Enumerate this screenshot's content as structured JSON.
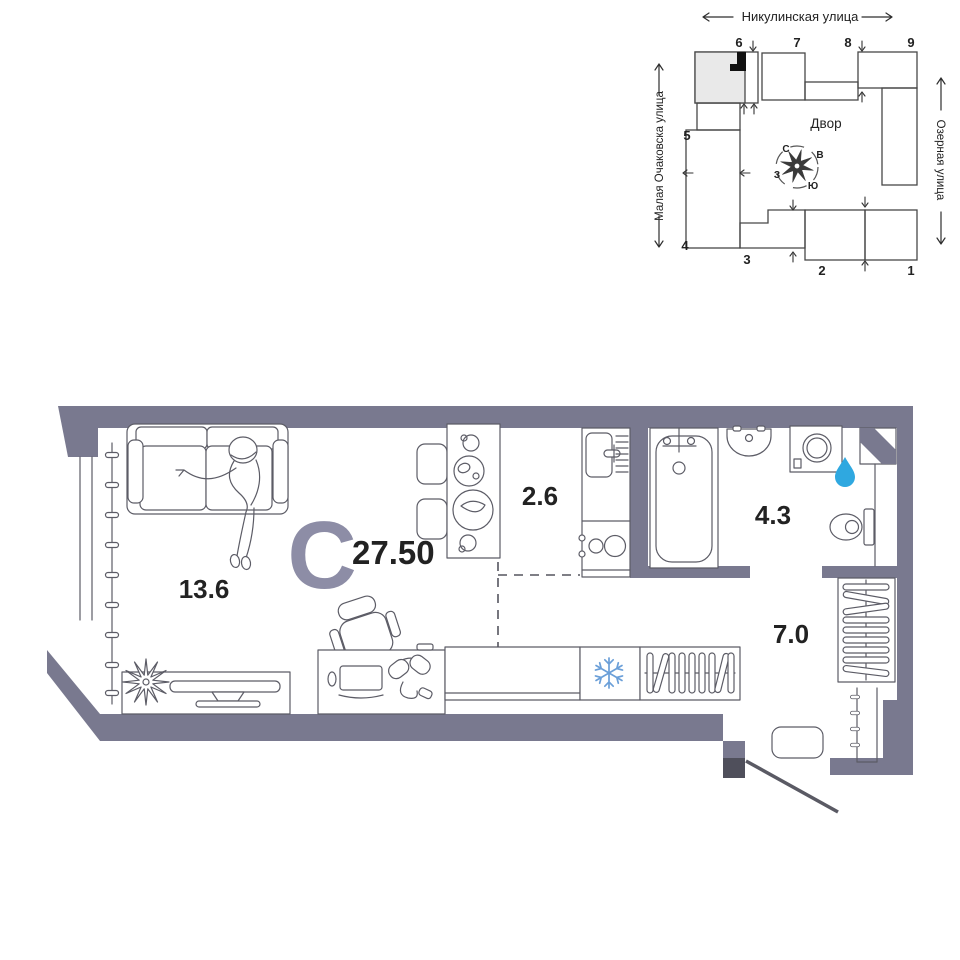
{
  "site_plan": {
    "streets": {
      "top": "Никулинская улица",
      "left": "Малая Очаковска улица",
      "right": "Озерная улица"
    },
    "courtyard_label": "Двор",
    "compass": {
      "north": "С",
      "east": "В",
      "south": "Ю",
      "west": "З"
    },
    "building_numbers": [
      "1",
      "2",
      "3",
      "4",
      "5",
      "6",
      "7",
      "8",
      "9"
    ]
  },
  "floor_plan": {
    "apartment_type_letter": "С",
    "total_area": "27.50",
    "rooms": {
      "living_room": {
        "area": "13.6"
      },
      "kitchen": {
        "area": "2.6"
      },
      "bathroom": {
        "area": "4.3"
      },
      "hallway": {
        "area": "7.0"
      }
    },
    "icons": [
      "water-drop-icon",
      "snowflake-icon",
      "compass-rose-icon",
      "location-marker-icon"
    ],
    "colors": {
      "wall": "#79798f",
      "type_letter": "#8d8da6",
      "water_drop": "#2fa8e0",
      "snowflake": "#6b9fd8",
      "highlighted_building": "#e9e9e9",
      "location_marker": "#111111"
    }
  }
}
